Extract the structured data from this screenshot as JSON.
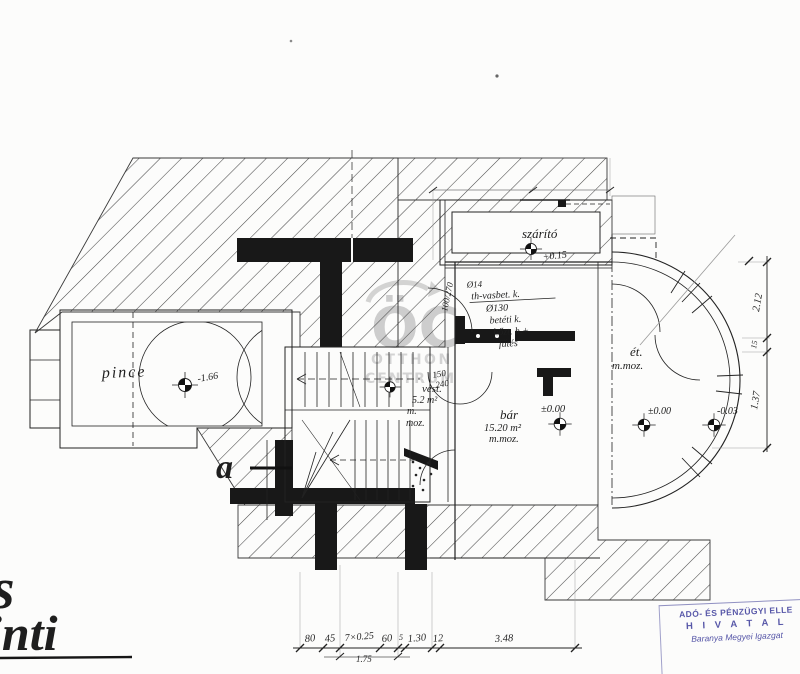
{
  "watermark": {
    "logo": "ÖC",
    "line1": "OTTHON",
    "line2": "CENTRUM"
  },
  "rooms": {
    "pince": {
      "label": "pince",
      "level": "-1.66"
    },
    "szarito": {
      "label": "szárító",
      "level": "+0.15"
    },
    "vest": {
      "l1": "vest.",
      "l2": "5.2 m²",
      "l3": "m.",
      "l4": "moz."
    },
    "bar": {
      "l1": "bár",
      "l2": "15.20 m²",
      "l3": "m.moz.",
      "level": "±0.00"
    },
    "et": {
      "l1": "ét.",
      "l2": "m.moz.",
      "level_a": "±0.00",
      "level_b": "-0.03"
    }
  },
  "notes": {
    "l1": "Ø14",
    "l2": "th-vasbet. k.",
    "l3": "Ø130",
    "l4": "betéti k.",
    "l5": "hőzt. h.+",
    "l6": "fűtés"
  },
  "doors": {
    "d1": "100/270",
    "d2_top": "150",
    "d2_bottom": "240"
  },
  "marker": {
    "section": "a"
  },
  "handwriting": {
    "l1": "s",
    "l2": "inti"
  },
  "dims": {
    "bottom": [
      "80",
      "45",
      "7×0.25",
      "60",
      "5",
      "1.30",
      "12",
      "3.48"
    ],
    "bottom_sub": "1.75",
    "right": [
      "2.12",
      "15",
      "1.37"
    ]
  },
  "stamp": {
    "l1": "ADÓ- ÉS PÉNZÜGYI ELLE",
    "l2": "H I V A T A L",
    "l3": "Baranya Megyei Igazgat"
  },
  "colors": {
    "ink": "#222222",
    "stamp": "#5757a8",
    "watermark": "#c2c2c2"
  }
}
